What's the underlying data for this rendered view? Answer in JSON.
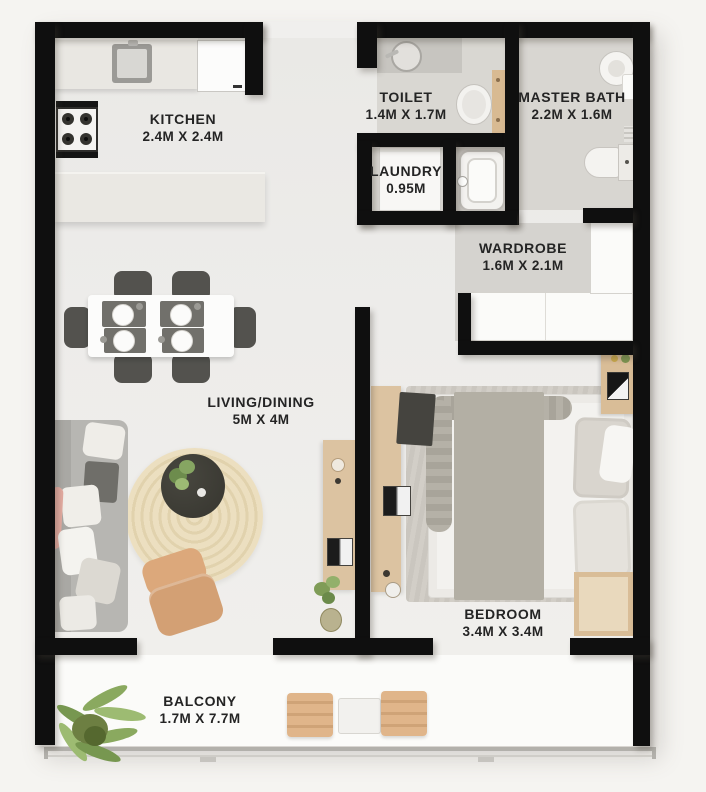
{
  "plan_type": "apartment-floor-plan",
  "rooms": [
    {
      "id": "kitchen",
      "label": "KITCHEN",
      "dims": "2.4M X 2.4M"
    },
    {
      "id": "toilet",
      "label": "TOILET",
      "dims": "1.4M X 1.7M"
    },
    {
      "id": "master-bath",
      "label": "MASTER BATH",
      "dims": "2.2M X 1.6M"
    },
    {
      "id": "laundry",
      "label": "LAUNDRY",
      "dims": "0.95M"
    },
    {
      "id": "wardrobe",
      "label": "WARDROBE",
      "dims": "1.6M X 2.1M"
    },
    {
      "id": "living-dining",
      "label": "LIVING/DINING",
      "dims": "5M X 4M"
    },
    {
      "id": "bedroom",
      "label": "BEDROOM",
      "dims": "3.4M X 3.4M"
    },
    {
      "id": "balcony",
      "label": "BALCONY",
      "dims": "1.7M X 7.7M"
    }
  ],
  "colors": {
    "wall": "#0f0f0f",
    "main_floor": "#edecea",
    "bath_floor": "#d8d6d1",
    "wardrobe_floor": "#d5d3cf",
    "balcony_floor": "#fbfbf9",
    "counter": "#e9e7e2",
    "wood": "#dcc3a1",
    "terracotta": "#d8a97c",
    "sofa_gray": "#b8b7b3",
    "label_text": "#242424"
  }
}
